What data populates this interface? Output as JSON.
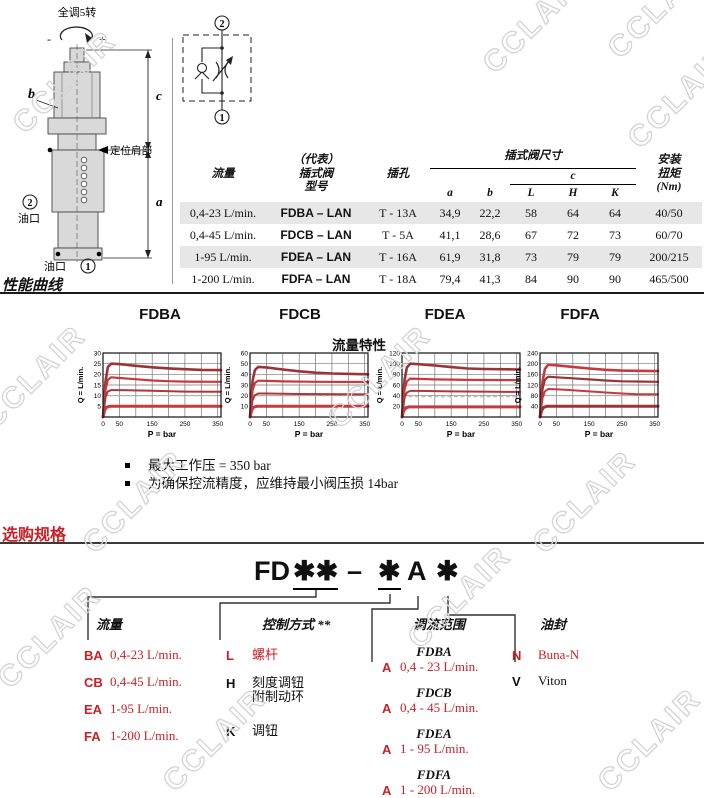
{
  "colors": {
    "red": "#c92127",
    "shade": "#e7e7e7",
    "grid": "#777777",
    "watermark": "#d4d4d4"
  },
  "watermark": {
    "text": "CCLAIR"
  },
  "drawing": {
    "turns_label": "全调5转",
    "minus": "-",
    "plus": "+",
    "b": "b",
    "c": "c",
    "a": "a",
    "shoulder_label": "定位肩部",
    "port2_circle": "2",
    "port2_label": "油口",
    "port1_label": "油口",
    "port1_circle": "1"
  },
  "schematic": {
    "top_port": "2",
    "bottom_port": "1"
  },
  "spec_table": {
    "headers": {
      "flow": "流量",
      "model": "（代表）\n插式阀\n型号",
      "cavity": "插孔",
      "dims_group": "插式阀尺寸",
      "a": "a",
      "b": "b",
      "c": "c",
      "L": "L",
      "H": "H",
      "K": "K",
      "torque": "安装\n扭矩\n(Nm)"
    },
    "rows": [
      {
        "flow": "0,4-23 L/min.",
        "model": "FDBA – LAN",
        "cavity": "T - 13A",
        "a": "34,9",
        "b": "22,2",
        "L": "58",
        "H": "64",
        "K": "64",
        "torque": "40/50",
        "shaded": true
      },
      {
        "flow": "0,4-45 L/min.",
        "model": "FDCB – LAN",
        "cavity": "T - 5A",
        "a": "41,1",
        "b": "28,6",
        "L": "67",
        "H": "72",
        "K": "73",
        "torque": "60/70",
        "shaded": false
      },
      {
        "flow": "1-95 L/min.",
        "model": "FDEA – LAN",
        "cavity": "T - 16A",
        "a": "61,9",
        "b": "31,8",
        "L": "73",
        "H": "79",
        "K": "79",
        "torque": "200/215",
        "shaded": true
      },
      {
        "flow": "1-200 L/min.",
        "model": "FDFA – LAN",
        "cavity": "T - 18A",
        "a": "79,4",
        "b": "41,3",
        "L": "84",
        "H": "90",
        "K": "90",
        "torque": "465/500",
        "shaded": false
      }
    ]
  },
  "performance": {
    "heading": "性能曲线",
    "flow_char_label": "流量特性",
    "notes": [
      "最大工作压 = 350 bar",
      "为确保控流精度，应维持最小阀压损 14bar"
    ]
  },
  "chart_data": [
    {
      "type": "line",
      "title": "FDBA",
      "xlabel": "P = bar",
      "ylabel": "Q = L/min.",
      "xlim": [
        0,
        360
      ],
      "ylim": [
        0,
        30
      ],
      "xticks": [
        0,
        50,
        150,
        250,
        350
      ],
      "yticks": [
        5,
        10,
        15,
        20,
        25,
        30
      ],
      "grid": true,
      "dashed_reference_y": 10,
      "series": [
        {
          "color": "#9c3336",
          "width": 2.6,
          "points": [
            [
              0,
              0
            ],
            [
              8,
              17
            ],
            [
              15,
              23.5
            ],
            [
              25,
              25
            ],
            [
              50,
              24.8
            ],
            [
              100,
              24
            ],
            [
              150,
              23.3
            ],
            [
              200,
              22.8
            ],
            [
              250,
              22.4
            ],
            [
              300,
              22.1
            ],
            [
              360,
              22
            ]
          ]
        },
        {
          "color": "#c53a3f",
          "width": 2.2,
          "points": [
            [
              0,
              0
            ],
            [
              8,
              13
            ],
            [
              15,
              17.5
            ],
            [
              25,
              18.6
            ],
            [
              50,
              18.3
            ],
            [
              100,
              17.7
            ],
            [
              150,
              17.1
            ],
            [
              200,
              16.8
            ],
            [
              250,
              16.6
            ],
            [
              360,
              16.5
            ]
          ]
        },
        {
          "color": "#b03538",
          "width": 2.0,
          "points": [
            [
              0,
              0
            ],
            [
              8,
              9.5
            ],
            [
              15,
              12
            ],
            [
              25,
              12.6
            ],
            [
              50,
              12.6
            ],
            [
              150,
              12.3
            ],
            [
              250,
              11.9
            ],
            [
              360,
              11.8
            ]
          ]
        },
        {
          "color": "#c53a3f",
          "width": 3.0,
          "points": [
            [
              0,
              0
            ],
            [
              5,
              3
            ],
            [
              10,
              4.5
            ],
            [
              20,
              5
            ],
            [
              360,
              5
            ]
          ]
        }
      ]
    },
    {
      "type": "line",
      "title": "FDCB",
      "xlabel": "P = bar",
      "ylabel": "Q = L/min.",
      "xlim": [
        0,
        360
      ],
      "ylim": [
        0,
        60
      ],
      "xticks": [
        0,
        50,
        150,
        250,
        350
      ],
      "yticks": [
        10,
        20,
        30,
        40,
        50,
        60
      ],
      "grid": true,
      "dashed_reference_y": 20,
      "series": [
        {
          "color": "#9c3336",
          "width": 2.6,
          "points": [
            [
              0,
              0
            ],
            [
              8,
              34
            ],
            [
              15,
              44
            ],
            [
              25,
              47
            ],
            [
              50,
              46.5
            ],
            [
              100,
              44.5
            ],
            [
              150,
              42.8
            ],
            [
              200,
              41.5
            ],
            [
              250,
              40.8
            ],
            [
              360,
              40
            ]
          ]
        },
        {
          "color": "#c53a3f",
          "width": 2.2,
          "points": [
            [
              0,
              0
            ],
            [
              8,
              25
            ],
            [
              15,
              32
            ],
            [
              25,
              34
            ],
            [
              50,
              33.8
            ],
            [
              100,
              33.4
            ],
            [
              200,
              33
            ],
            [
              360,
              32.8
            ]
          ]
        },
        {
          "color": "#b03538",
          "width": 2.0,
          "points": [
            [
              0,
              0
            ],
            [
              8,
              16
            ],
            [
              15,
              20.5
            ],
            [
              25,
              22
            ],
            [
              50,
              22
            ],
            [
              150,
              21.6
            ],
            [
              360,
              21.2
            ]
          ]
        },
        {
          "color": "#c53a3f",
          "width": 3.0,
          "points": [
            [
              0,
              0
            ],
            [
              5,
              6
            ],
            [
              10,
              9
            ],
            [
              20,
              10
            ],
            [
              360,
              10
            ]
          ]
        }
      ]
    },
    {
      "type": "line",
      "title": "FDEA",
      "xlabel": "P = bar",
      "ylabel": "Q = L/min.",
      "xlim": [
        0,
        360
      ],
      "ylim": [
        0,
        120
      ],
      "xticks": [
        0,
        50,
        150,
        250,
        350
      ],
      "yticks": [
        20,
        40,
        60,
        80,
        100,
        120
      ],
      "grid": true,
      "dashed_reference_y": 38,
      "series": [
        {
          "color": "#9c3336",
          "width": 2.6,
          "points": [
            [
              0,
              0
            ],
            [
              8,
              70
            ],
            [
              15,
              93
            ],
            [
              25,
              100
            ],
            [
              50,
              99
            ],
            [
              100,
              96.5
            ],
            [
              150,
              93.5
            ],
            [
              200,
              91
            ],
            [
              250,
              90
            ],
            [
              360,
              89
            ]
          ]
        },
        {
          "color": "#c53a3f",
          "width": 2.2,
          "points": [
            [
              0,
              0
            ],
            [
              8,
              52
            ],
            [
              15,
              67
            ],
            [
              25,
              72
            ],
            [
              50,
              71.5
            ],
            [
              100,
              70.5
            ],
            [
              200,
              69.5
            ],
            [
              360,
              69
            ]
          ]
        },
        {
          "color": "#b03538",
          "width": 2.0,
          "points": [
            [
              0,
              0
            ],
            [
              8,
              37
            ],
            [
              15,
              46
            ],
            [
              25,
              49
            ],
            [
              50,
              49
            ],
            [
              150,
              48
            ],
            [
              360,
              47
            ]
          ]
        },
        {
          "color": "#c53a3f",
          "width": 3.0,
          "points": [
            [
              0,
              0
            ],
            [
              5,
              11
            ],
            [
              10,
              16
            ],
            [
              20,
              19
            ],
            [
              360,
              19
            ]
          ]
        }
      ]
    },
    {
      "type": "line",
      "title": "FDFA",
      "xlabel": "P = bar",
      "ylabel": "Q = L/min.",
      "xlim": [
        0,
        360
      ],
      "ylim": [
        0,
        240
      ],
      "xticks": [
        0,
        50,
        150,
        250,
        350
      ],
      "yticks": [
        40,
        80,
        120,
        160,
        200,
        240
      ],
      "grid": true,
      "dashed_reference_y": 80,
      "series": [
        {
          "color": "#c53a3f",
          "width": 2.6,
          "points": [
            [
              0,
              0
            ],
            [
              8,
              135
            ],
            [
              15,
              180
            ],
            [
              25,
              196
            ],
            [
              50,
              194
            ],
            [
              100,
              188
            ],
            [
              150,
              182
            ],
            [
              200,
              177
            ],
            [
              250,
              174
            ],
            [
              360,
              172
            ]
          ]
        },
        {
          "color": "#9c3336",
          "width": 2.2,
          "points": [
            [
              0,
              0
            ],
            [
              8,
              105
            ],
            [
              15,
              140
            ],
            [
              25,
              151
            ],
            [
              50,
              149
            ],
            [
              100,
              145
            ],
            [
              150,
              141
            ],
            [
              200,
              137
            ],
            [
              250,
              134
            ],
            [
              360,
              132
            ]
          ]
        },
        {
          "color": "#c53a3f",
          "width": 2.0,
          "points": [
            [
              0,
              0
            ],
            [
              8,
              72
            ],
            [
              15,
              96
            ],
            [
              25,
              105
            ],
            [
              50,
              104
            ],
            [
              100,
              100
            ],
            [
              150,
              96
            ],
            [
              200,
              92
            ],
            [
              250,
              88
            ],
            [
              300,
              85
            ],
            [
              360,
              85
            ]
          ]
        },
        {
          "color": "#9c3336",
          "width": 3.0,
          "points": [
            [
              0,
              0
            ],
            [
              5,
              24
            ],
            [
              10,
              35
            ],
            [
              20,
              40
            ],
            [
              360,
              40
            ]
          ]
        }
      ]
    }
  ],
  "ordering": {
    "heading": "选购规格",
    "code": {
      "prefix": "FD",
      "stars_flow": "✱✱",
      "dash": "–",
      "star_control": "✱",
      "range_letter": "A",
      "star_seal": "✱"
    },
    "flow": {
      "label": "流量",
      "items": [
        [
          "BA",
          "0,4-23 L/min."
        ],
        [
          "CB",
          "0,4-45 L/min."
        ],
        [
          "EA",
          "1-95 L/min."
        ],
        [
          "FA",
          "1-200 L/min."
        ]
      ]
    },
    "control": {
      "label": "控制方式 **",
      "items": [
        [
          "L",
          "螺杆",
          "red"
        ],
        [
          "H",
          "刻度调钮\n附制动环",
          "black"
        ],
        [
          "K",
          "调钮",
          "black"
        ]
      ]
    },
    "range": {
      "label": "调流范围",
      "items": [
        [
          "FDBA",
          "A",
          "0,4 - 23 L/min."
        ],
        [
          "FDCB",
          "A",
          "0,4 - 45 L/min."
        ],
        [
          "FDEA",
          "A",
          "1 - 95 L/min."
        ],
        [
          "FDFA",
          "A",
          "1 - 200 L/min."
        ]
      ]
    },
    "seal": {
      "label": "油封",
      "items": [
        [
          "N",
          "Buna-N",
          "red"
        ],
        [
          "V",
          "Viton",
          "black"
        ]
      ]
    }
  }
}
